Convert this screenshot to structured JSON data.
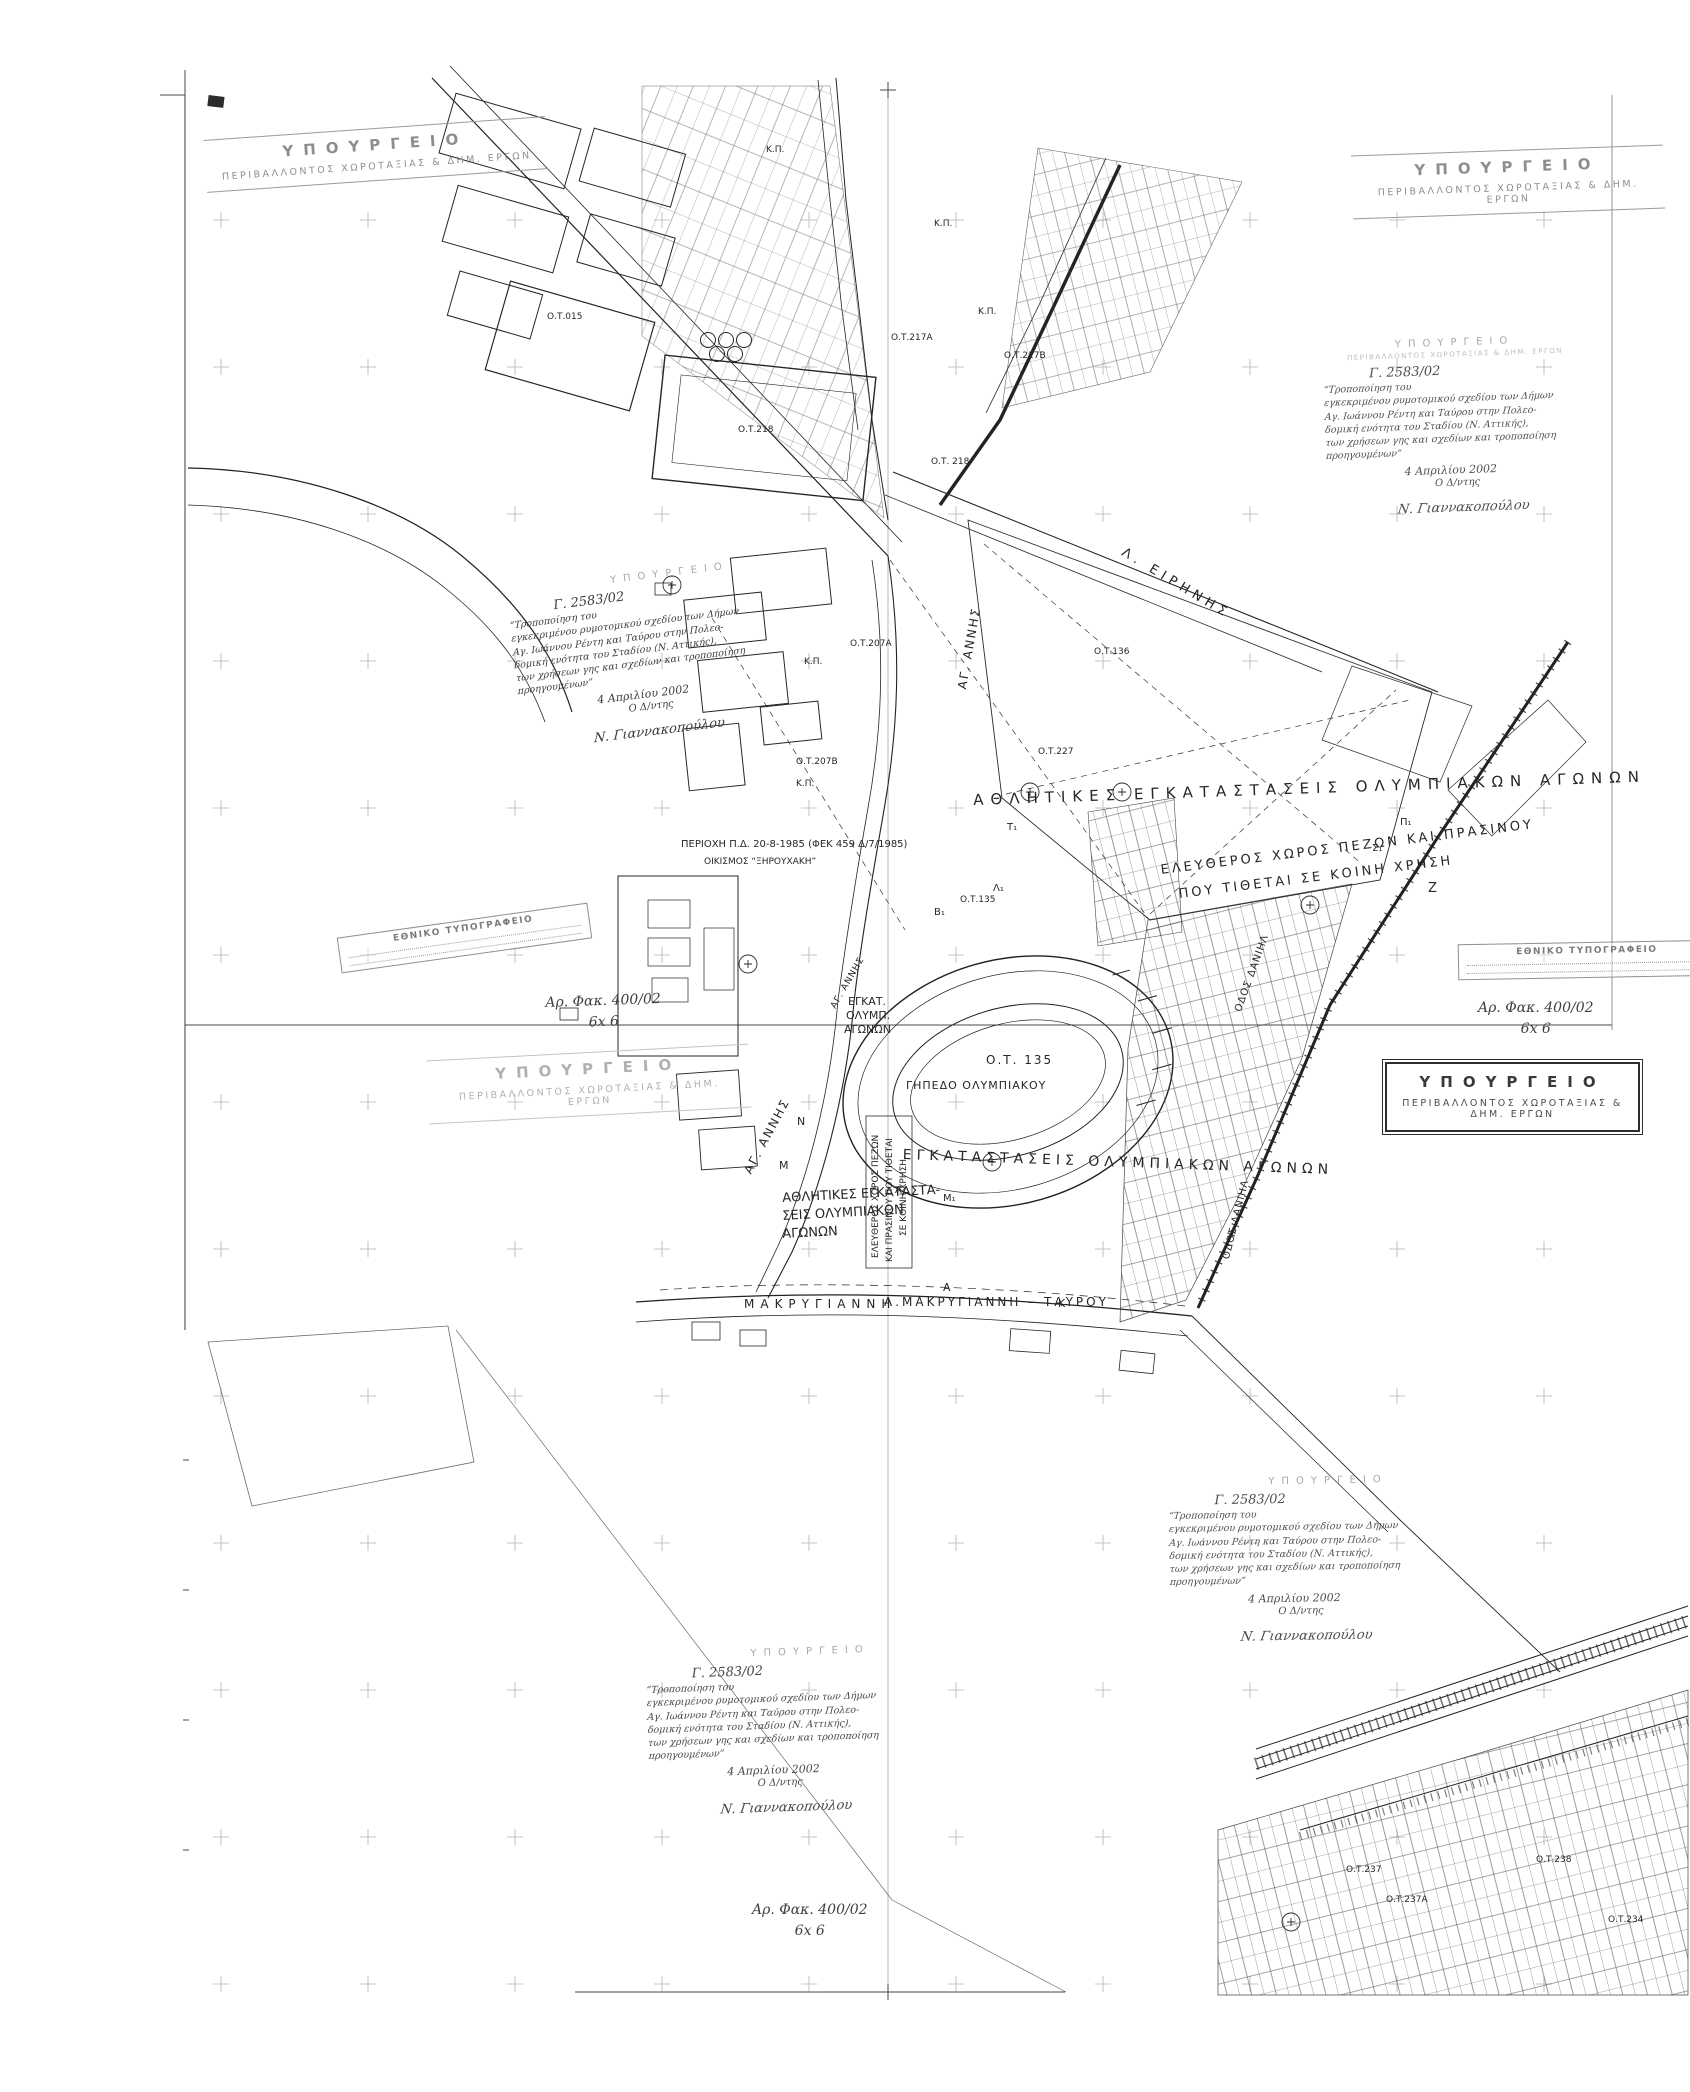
{
  "stamps": {
    "ministry": {
      "line1": "ΥΠΟΥΡΓΕΙΟ",
      "line2": "ΠΕΡΙΒΑΛΛΟΝΤΟΣ ΧΩΡΟΤΑΞΙΑΣ & ΔΗΜ. ΕΡΓΩΝ"
    },
    "printing_office": {
      "line1": "ΕΘΝΙΚΟ ΤΥΠΟΓΡΑΦΕΙΟ"
    }
  },
  "approval_note": {
    "header": "ΥΠΟΥΡΓΕΙΟ",
    "protocol": "Γ. 2583/02",
    "body": [
      "“Τροποποίηση του",
      "εγκεκριμένου ρυμοτομικού σχεδίου των Δήμων",
      "Αγ. Ιωάννου Ρέντη και Ταύρου στην Πολεο-",
      "δομική ενότητα του Σταδίου (Ν. Αττικής),",
      "των χρήσεων γης και σχεδίων και τροποποίηση",
      "προηγουμένων”"
    ],
    "date": "4 Απριλίου 2002",
    "signoff": "Ο Δ/ντης",
    "signature": "Ν. Γιαννακοπούλου"
  },
  "file_note": {
    "line1": "Αρ. Φακ. 400/02",
    "line2": "6x 6"
  },
  "map_labels": [
    {
      "t": "ΑΘΛΗΤΙΚΕΣ  ΕΓΚΑΤΑΣΤΑΣΕΙΣ  ΟΛΥΜΠΙΑΚΩΝ  ΑΓΩΝΩΝ",
      "x": 973,
      "y": 793,
      "r": -2,
      "s": 15,
      "ls": 7
    },
    {
      "t": "ΕΛΕΥΘΕΡΟΣ ΧΩΡΟΣ ΠΕΖΩΝ ΚΑΙ ΠΡΑΣΙΝΟΥ",
      "x": 1160,
      "y": 864,
      "r": -7,
      "s": 13,
      "ls": 3
    },
    {
      "t": "ΠΟΥ ΤΙΘΕΤΑΙ ΣΕ ΚΟΙΝΗ ΧΡΗΣΗ",
      "x": 1178,
      "y": 888,
      "r": -7,
      "s": 13,
      "ls": 3
    },
    {
      "t": "Ζ",
      "x": 1428,
      "y": 882,
      "s": 13
    },
    {
      "t": "ΕΓΚΑΤΑΣΤΑΣΕΙΣ  ΟΛΥΜΠΙΑΚΩΝ  ΑΓΩΝΩΝ",
      "x": 903,
      "y": 1148,
      "r": 2,
      "s": 14,
      "ls": 5
    },
    {
      "t": "ΑΘΛΗΤΙΚΕΣ ΕΓΚΑΤΑΣΤΑ-",
      "x": 782,
      "y": 1192,
      "r": -3,
      "s": 13
    },
    {
      "t": "ΣΕΙΣ ΟΛΥΜΠΙΑΚΩΝ",
      "x": 782,
      "y": 1210,
      "r": -3,
      "s": 13
    },
    {
      "t": "ΑΓΩΝΩΝ",
      "x": 782,
      "y": 1228,
      "r": -3,
      "s": 13
    },
    {
      "t": "ΕΓΚΑΤ.",
      "x": 848,
      "y": 996,
      "s": 11
    },
    {
      "t": "ΟΛΥΜΠ.",
      "x": 846,
      "y": 1010,
      "s": 11
    },
    {
      "t": "ΑΓΩΝΩΝ",
      "x": 844,
      "y": 1024,
      "s": 11
    },
    {
      "t": "ΓΗΠΕΔΟ ΟΛΥΜΠΙΑΚΟΥ",
      "x": 906,
      "y": 1080,
      "s": 11,
      "ls": 1
    },
    {
      "t": "Ο.Τ. 135",
      "x": 986,
      "y": 1054,
      "s": 12,
      "ls": 2
    },
    {
      "t": "Ο.Τ.135",
      "x": 960,
      "y": 896,
      "s": 9
    },
    {
      "t": "ΜΑΚΡΥΓΙΑΝΝΗ",
      "x": 744,
      "y": 1298,
      "s": 12,
      "ls": 6
    },
    {
      "t": "Λ.ΜΑΚΡΥΓΙΑΝΝΗ – ΤΑΥΡΟΥ",
      "x": 884,
      "y": 1296,
      "s": 12,
      "ls": 3
    },
    {
      "t": "Λ. ΕΙΡΗΝΗΣ",
      "x": 1126,
      "y": 546,
      "r": 31,
      "s": 13,
      "ls": 5
    },
    {
      "t": "ΑΓ. ΑΝΝΗΣ",
      "x": 956,
      "y": 688,
      "r": -80,
      "s": 12,
      "ls": 2
    },
    {
      "t": "ΑΓ. ΑΝΝΗΣ",
      "x": 742,
      "y": 1170,
      "r": -62,
      "s": 12,
      "ls": 2
    },
    {
      "t": "ΑΓ. ΑΝΝΗΣ",
      "x": 830,
      "y": 1006,
      "r": -60,
      "s": 9,
      "ls": 1
    },
    {
      "t": "ΟΔΟΣ ΔΑΝΙΗΛ",
      "x": 1234,
      "y": 1010,
      "r": -70,
      "s": 10,
      "ls": 1
    },
    {
      "t": "ΟΔΟΣ ΔΑΝΙΗΛ",
      "x": 1222,
      "y": 1258,
      "r": -76,
      "s": 10,
      "ls": 1
    },
    {
      "t": "ΠΕΡΙΟΧΗ Π.Δ. 20-8-1985 (ΦΕΚ 459 Δ/7/1985)",
      "x": 681,
      "y": 840,
      "s": 10
    },
    {
      "t": "ΟΙΚΙΣΜΟΣ “ΞΗΡΟΥΧΑΚΗ”",
      "x": 704,
      "y": 858,
      "s": 9
    },
    {
      "t": "ΕΛΕΥΘΕΡΟΣ ΧΩΡΟΣ ΠΕΖΩΝ",
      "x": 872,
      "y": 1258,
      "r": -90,
      "s": 9
    },
    {
      "t": "ΚΑΙ ΠΡΑΣΙΝΟΥ ΠΟΥ ΤΙΘΕΤΑΙ",
      "x": 886,
      "y": 1262,
      "r": -90,
      "s": 9
    },
    {
      "t": "ΣΕ ΚΟΙΝΗ ΧΡΗΣΗ",
      "x": 900,
      "y": 1236,
      "r": -90,
      "s": 9
    },
    {
      "t": "Ο.Τ.015",
      "x": 547,
      "y": 313,
      "s": 9
    },
    {
      "t": "Ο.Τ.218",
      "x": 738,
      "y": 426,
      "s": 9
    },
    {
      "t": "Ο.Τ. 218",
      "x": 931,
      "y": 458,
      "s": 9
    },
    {
      "t": "Ο.Τ.217Α",
      "x": 891,
      "y": 334,
      "s": 9
    },
    {
      "t": "Ο.Τ.217Β",
      "x": 1004,
      "y": 352,
      "s": 9
    },
    {
      "t": "Ο.Τ.136",
      "x": 1094,
      "y": 648,
      "s": 9
    },
    {
      "t": "Ο.Τ.227",
      "x": 1038,
      "y": 748,
      "s": 9
    },
    {
      "t": "Ο.Τ.207Α",
      "x": 850,
      "y": 640,
      "s": 9
    },
    {
      "t": "Ο.Τ.207Β",
      "x": 796,
      "y": 758,
      "s": 9
    },
    {
      "t": "Κ.Π.",
      "x": 804,
      "y": 658,
      "s": 9
    },
    {
      "t": "Κ.Π.",
      "x": 796,
      "y": 780,
      "s": 9
    },
    {
      "t": "Κ.Π.",
      "x": 766,
      "y": 146,
      "s": 9
    },
    {
      "t": "Κ.Π.",
      "x": 934,
      "y": 220,
      "s": 9
    },
    {
      "t": "Κ.Π.",
      "x": 978,
      "y": 308,
      "s": 9
    },
    {
      "t": "Ο.Τ.238",
      "x": 1536,
      "y": 1856,
      "s": 9
    },
    {
      "t": "Ο.Τ.237",
      "x": 1346,
      "y": 1866,
      "s": 9
    },
    {
      "t": "Ο.Τ.237Α",
      "x": 1386,
      "y": 1896,
      "s": 9
    },
    {
      "t": "Ο.Τ.234",
      "x": 1608,
      "y": 1916,
      "s": 9
    },
    {
      "t": "Α",
      "x": 943,
      "y": 1282,
      "s": 11
    },
    {
      "t": "Κ",
      "x": 1058,
      "y": 1298,
      "s": 11
    },
    {
      "t": "Μ",
      "x": 779,
      "y": 1160,
      "s": 11
    },
    {
      "t": "Μ₁",
      "x": 943,
      "y": 1194,
      "s": 10
    },
    {
      "t": "Α₁",
      "x": 895,
      "y": 1186,
      "s": 10
    },
    {
      "t": "Ν",
      "x": 797,
      "y": 1116,
      "s": 11
    },
    {
      "t": "Β₁",
      "x": 934,
      "y": 908,
      "s": 10
    },
    {
      "t": "Λ₁",
      "x": 993,
      "y": 884,
      "s": 10
    },
    {
      "t": "Τ₁",
      "x": 1007,
      "y": 823,
      "s": 10
    },
    {
      "t": "Σ₁",
      "x": 1372,
      "y": 844,
      "s": 10
    },
    {
      "t": "Π₁",
      "x": 1400,
      "y": 818,
      "s": 10
    }
  ]
}
